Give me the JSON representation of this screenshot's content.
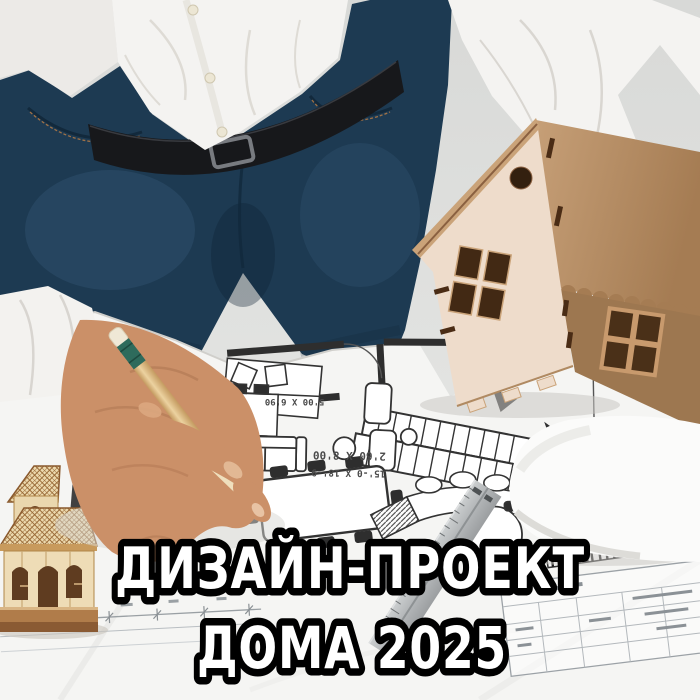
{
  "overlay": {
    "line1": "ДИЗАЙН-ПРОЕКТ",
    "line2": "ДОМА 2025",
    "fill": "#ffffff",
    "outline": "#000000"
  },
  "floor_plan": {
    "dimension_labels": [
      "2'60 X 8'00",
      "15'-0 X 18'-9",
      "5'00 X 6'90",
      "5'60 X 8'0"
    ]
  },
  "colors": {
    "background": "#dcdddb",
    "paper": "#f5f5f3",
    "plan_ink": "#2e2e2e",
    "shirt": "#f4f3f1",
    "jeans": "#1d3a52",
    "belt": "#17181b",
    "skin": "#cb9068",
    "pencil_body": "#e3c globalization",
    "pencil_band": "#2e6b5c",
    "wood_light": "#eedccb",
    "wood_dark": "#9d7750",
    "small_house_wood": "#eedcb6",
    "plate": "#fbfbfa",
    "ruler": "#b7babc"
  }
}
